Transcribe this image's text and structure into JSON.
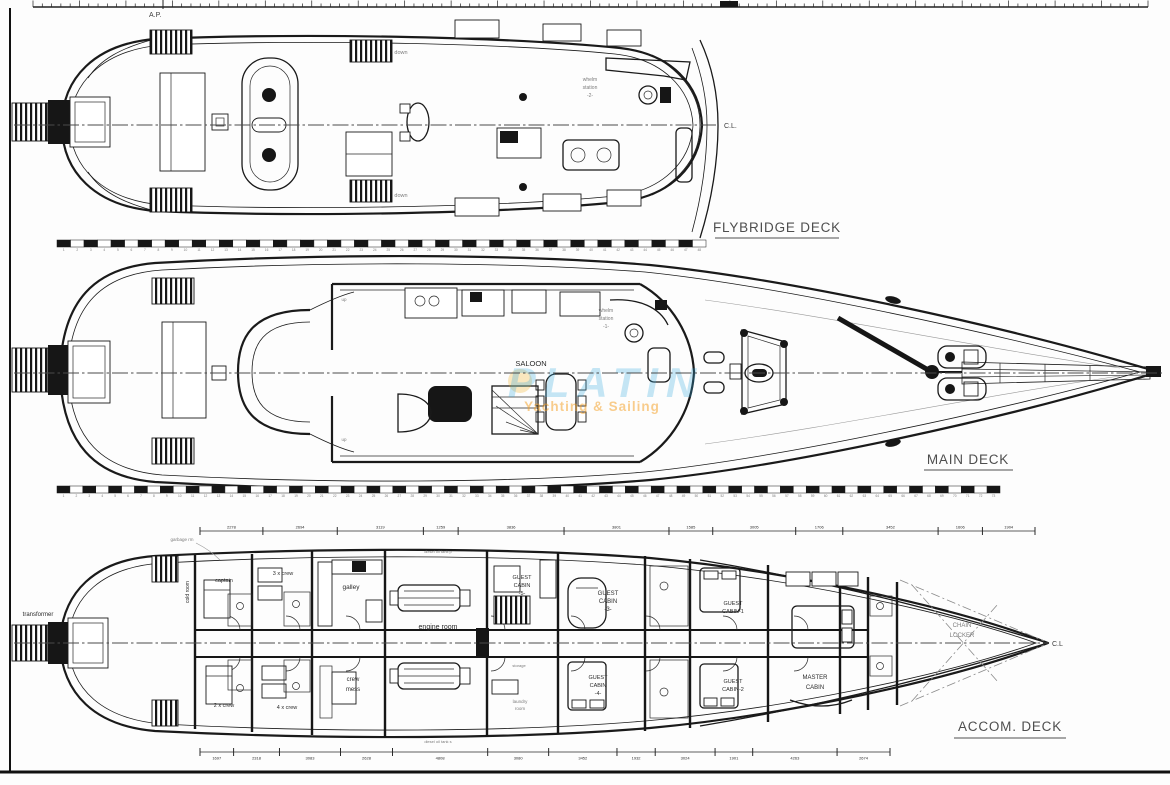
{
  "header": {
    "ap_label": "A.P.",
    "cl_label_flybridge": "C.L.",
    "cl_label_accom": "C.L"
  },
  "watermark": {
    "brand": "PLATIN",
    "tagline": "Yachting & Sailing",
    "blue": "#35aade",
    "orange": "#f59d1d"
  },
  "deck_titles": {
    "flybridge": "FLYBRIDGE DECK",
    "main": "MAIN DECK",
    "accom": "ACCOM. DECK"
  },
  "flybridge": {
    "labels": [
      {
        "t": "down",
        "x": 401,
        "y": 54,
        "s": 5.5,
        "c": 1
      },
      {
        "t": "down",
        "x": 401,
        "y": 197,
        "s": 5.5,
        "c": 1
      },
      {
        "t": "whelm",
        "x": 590,
        "y": 81,
        "s": 5,
        "c": 1
      },
      {
        "t": "station",
        "x": 590,
        "y": 89,
        "s": 5,
        "c": 1
      },
      {
        "t": "-2-",
        "x": 590,
        "y": 97,
        "s": 5,
        "c": 1
      }
    ]
  },
  "main": {
    "labels": [
      {
        "t": "SALOON",
        "x": 531,
        "y": 366,
        "s": 7.5
      },
      {
        "t": "whelm",
        "x": 606,
        "y": 312,
        "s": 5,
        "c": 1
      },
      {
        "t": "station",
        "x": 606,
        "y": 320,
        "s": 5,
        "c": 1
      },
      {
        "t": "-1-",
        "x": 606,
        "y": 328,
        "s": 5,
        "c": 1
      },
      {
        "t": "up",
        "x": 344,
        "y": 301,
        "s": 4.5,
        "c": 1
      },
      {
        "t": "up",
        "x": 344,
        "y": 441,
        "s": 4.5,
        "c": 1
      }
    ]
  },
  "accom": {
    "labels": [
      {
        "t": "transformer",
        "x": 38,
        "y": 616,
        "s": 6
      },
      {
        "t": "garbage rm",
        "x": 182,
        "y": 541,
        "s": 4.5,
        "c": 1
      },
      {
        "t": "cold room",
        "x": 189,
        "y": 592,
        "s": 5,
        "r": -90
      },
      {
        "t": "captain",
        "x": 224,
        "y": 582,
        "s": 5.5
      },
      {
        "t": "3 x crew",
        "x": 283,
        "y": 575,
        "s": 5.5
      },
      {
        "t": "galley",
        "x": 351,
        "y": 589,
        "s": 6.5
      },
      {
        "t": "2 x crew",
        "x": 224,
        "y": 707,
        "s": 5.5
      },
      {
        "t": "4 x crew",
        "x": 287,
        "y": 709,
        "s": 5.5
      },
      {
        "t": "crew",
        "x": 353,
        "y": 681,
        "s": 6
      },
      {
        "t": "mess",
        "x": 353,
        "y": 691,
        "s": 6
      },
      {
        "t": "engine room",
        "x": 438,
        "y": 629,
        "s": 7
      },
      {
        "t": "diesel oil tank p",
        "x": 438,
        "y": 553,
        "s": 4,
        "c": 1
      },
      {
        "t": "diesel oil tank s",
        "x": 438,
        "y": 743,
        "s": 4,
        "c": 1
      },
      {
        "t": "storage",
        "x": 519,
        "y": 667,
        "s": 4,
        "c": 1
      },
      {
        "t": "laundry",
        "x": 520,
        "y": 703,
        "s": 4.5,
        "c": 1
      },
      {
        "t": "room",
        "x": 520,
        "y": 710,
        "s": 4.5,
        "c": 1
      },
      {
        "t": "GUEST",
        "x": 522,
        "y": 579,
        "s": 5.5
      },
      {
        "t": "CABIN",
        "x": 522,
        "y": 587,
        "s": 5.5
      },
      {
        "t": "-5-",
        "x": 522,
        "y": 595,
        "s": 5.5
      },
      {
        "t": "GUEST",
        "x": 608,
        "y": 595,
        "s": 6
      },
      {
        "t": "CABIN",
        "x": 608,
        "y": 603,
        "s": 6
      },
      {
        "t": "-3-",
        "x": 608,
        "y": 611,
        "s": 6
      },
      {
        "t": "GUEST",
        "x": 733,
        "y": 605,
        "s": 5.5
      },
      {
        "t": "CABIN-1",
        "x": 733,
        "y": 613,
        "s": 5.5
      },
      {
        "t": "GUEST",
        "x": 598,
        "y": 679,
        "s": 5.5
      },
      {
        "t": "CABIN",
        "x": 598,
        "y": 687,
        "s": 5.5
      },
      {
        "t": "-4-",
        "x": 598,
        "y": 695,
        "s": 5.5
      },
      {
        "t": "GUEST",
        "x": 733,
        "y": 683,
        "s": 5.5
      },
      {
        "t": "CABIN-2",
        "x": 733,
        "y": 691,
        "s": 5.5
      },
      {
        "t": "MASTER",
        "x": 815,
        "y": 679,
        "s": 6
      },
      {
        "t": "CABIN",
        "x": 815,
        "y": 689,
        "s": 6
      },
      {
        "t": "CHAIN",
        "x": 962,
        "y": 627,
        "s": 6,
        "c": 1
      },
      {
        "t": "LOCKER",
        "x": 962,
        "y": 637,
        "s": 6,
        "c": 1
      }
    ],
    "dims_top": {
      "y": 531,
      "x0": 200,
      "x1": 1035,
      "pos": "above",
      "values": [
        2278,
        2694,
        3119,
        1259,
        3836,
        3801,
        1585,
        3005,
        1706,
        3452,
        1606,
        1904
      ]
    },
    "dims_bottom": {
      "y": 752,
      "x0": 200,
      "x1": 890,
      "pos": "below",
      "values": [
        1697,
        2318,
        3083,
        2628,
        4808,
        3080,
        3452,
        1932,
        3024,
        1901,
        4263,
        2674
      ]
    }
  },
  "rulers": {
    "top_scale": {
      "x0": 33,
      "x1": 1148,
      "y": 7,
      "n": 120
    },
    "flybridge": {
      "x0": 57,
      "x1": 706,
      "y": 240,
      "h": 7,
      "n": 48,
      "numbers": true
    },
    "main": {
      "x0": 57,
      "x1": 1000,
      "y": 486,
      "h": 7,
      "n": 73,
      "numbers": true
    }
  }
}
